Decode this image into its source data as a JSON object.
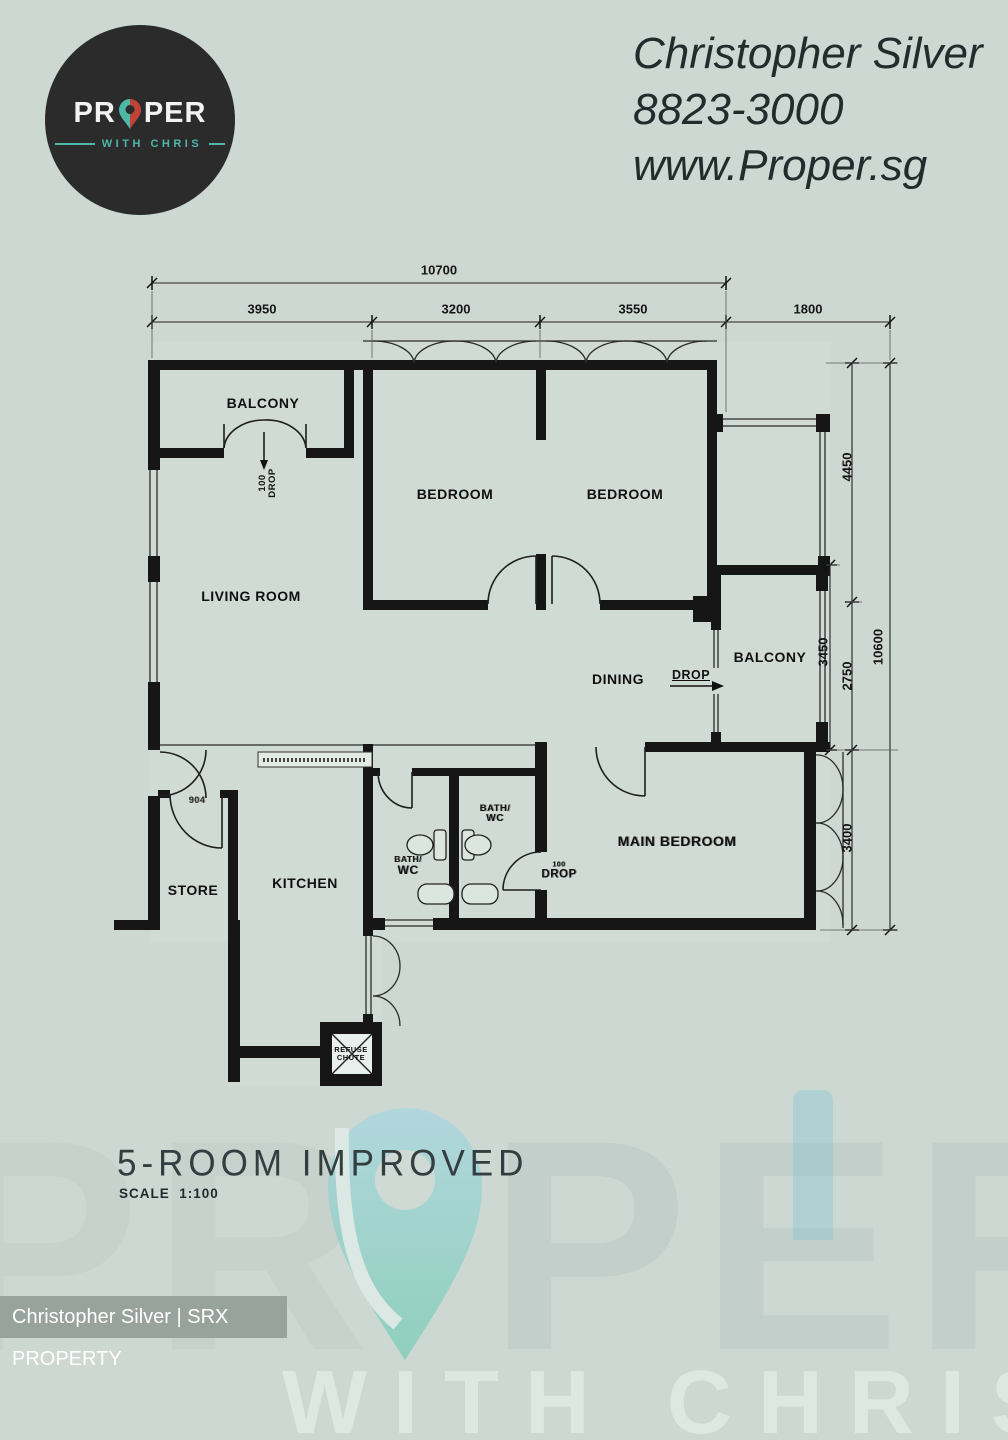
{
  "colors": {
    "background": "#cdd8d3",
    "wall": "#161616",
    "accent_teal": "#4db8a8",
    "accent_red": "#bf4437",
    "footer_bar": "#949e99"
  },
  "logo": {
    "wordmark_left": "PR",
    "wordmark_right": "PER",
    "tagline": "WITH CHRIS"
  },
  "agent": {
    "name": "Christopher Silver",
    "phone": "8823-3000",
    "website": "www.Proper.sg"
  },
  "rooms": {
    "balcony_top": "BALCONY",
    "bedroom_1": "BEDROOM",
    "bedroom_2": "BEDROOM",
    "living": "LIVING ROOM",
    "dining": "DINING",
    "balcony_right": "BALCONY",
    "main_bedroom": "MAIN BEDROOM",
    "kitchen": "KITCHEN",
    "store": "STORE",
    "bath_1_line1": "BATH/",
    "bath_1_line2": "WC",
    "bath_2_line1": "BATH/",
    "bath_2_line2": "WC",
    "refuse_line1": "REFUSE",
    "refuse_line2": "CHUTE"
  },
  "annotations": {
    "balcony_drop_line1": "100",
    "balcony_drop_line2": "DROP",
    "dining_drop": "DROP",
    "bedroom_drop_line1": "100",
    "bedroom_drop_line2": "DROP",
    "entry_label": "904"
  },
  "dimensions": {
    "total_width": "10700",
    "width_1": "3950",
    "width_2": "3200",
    "width_3": "3550",
    "width_4": "1800",
    "height_1": "4450",
    "height_balcony": "3450",
    "height_2": "2750",
    "height_3": "3400",
    "total_height": "10600"
  },
  "title": {
    "plan_type": "5-ROOM IMPROVED",
    "scale": "SCALE  1:100"
  },
  "footer": {
    "credit": "Christopher Silver | SRX PROPERTY"
  },
  "watermark": {
    "word_left": "PR",
    "word_right": "PER",
    "tagline": "WITH CHRIS"
  }
}
